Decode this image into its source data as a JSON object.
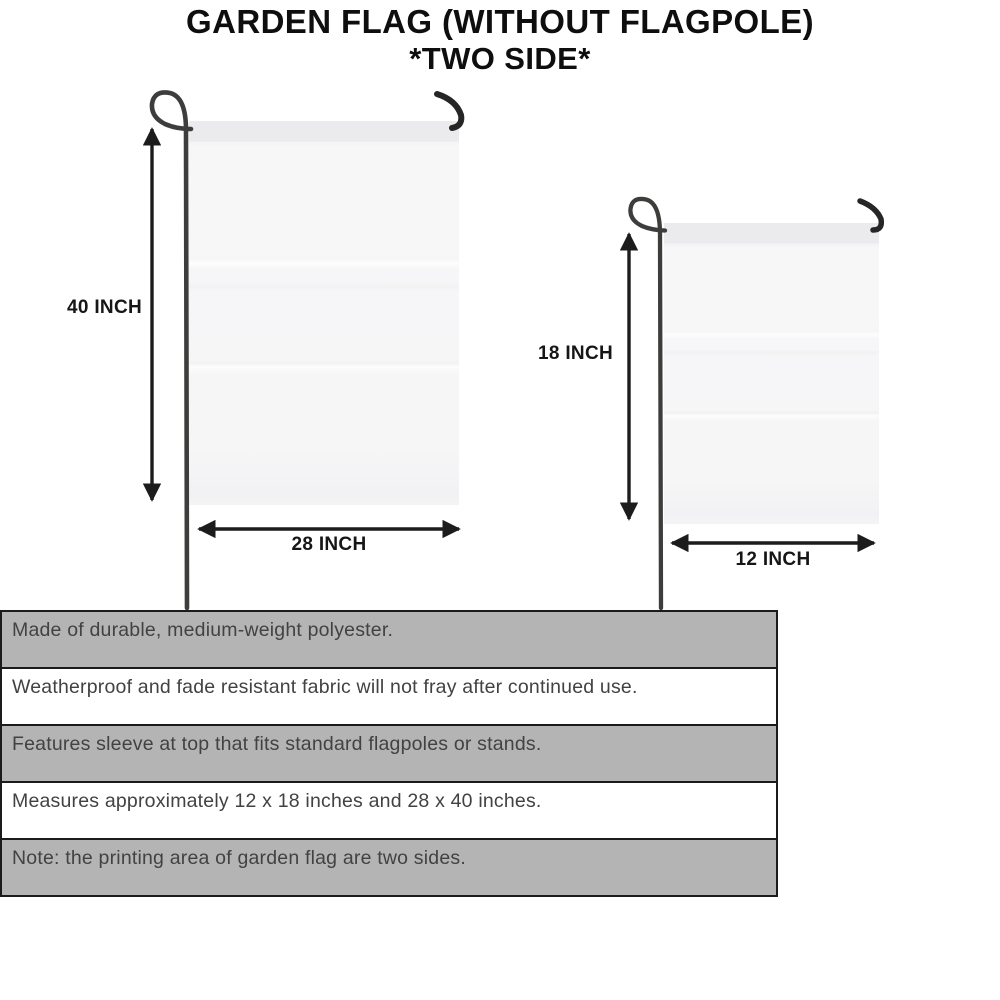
{
  "title": {
    "line1": "GARDEN FLAG (WITHOUT FLAGPOLE)",
    "line2": "*TWO SIDE*"
  },
  "flags": {
    "large": {
      "height_label": "40 INCH",
      "width_label": "28 INCH"
    },
    "small": {
      "height_label": "18 INCH",
      "width_label": "12 INCH"
    }
  },
  "features": [
    {
      "text": "Made of durable, medium-weight polyester.",
      "shaded": true
    },
    {
      "text": "Weatherproof and fade resistant fabric will not fray after continued use.",
      "shaded": false
    },
    {
      "text": "Features sleeve at top that fits standard flagpoles or stands.",
      "shaded": true
    },
    {
      "text": "Measures approximately 12 x 18 inches and 28 x 40 inches.",
      "shaded": false
    },
    {
      "text": "Note: the printing area of garden flag are two sides.",
      "shaded": true
    }
  ],
  "icons": {
    "pole_loop": "flagpole-loop-icon",
    "pole_hook": "flagpole-hook-icon",
    "dimension_arrow": "double-arrow-icon"
  },
  "colors": {
    "row_shaded": "#b5b4b4",
    "row_plain": "#ffffff",
    "table_border": "#1b1b1b",
    "flag_fill": "#f6f6f7",
    "flag_sleeve": "#ebebed",
    "line": "#1c1c1c",
    "pole": "#3d3d3b",
    "title_text": "#0e0e0e",
    "feature_text": "#424242"
  }
}
